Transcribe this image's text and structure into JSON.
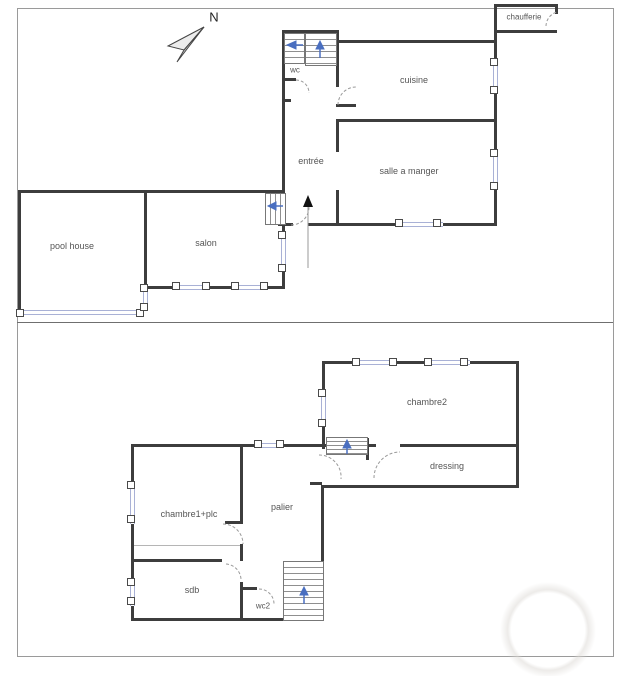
{
  "compass": {
    "label": "N"
  },
  "rooms": {
    "chaufferie": "chaufferie",
    "wc": "wc",
    "cuisine": "cuisine",
    "entree": "entrée",
    "salle_a_manger": "salle a manger",
    "pool_house": "pool house",
    "salon": "salon",
    "chambre2": "chambre2",
    "dressing": "dressing",
    "chambre1_plc": "chambre1+plc",
    "palier": "palier",
    "sdb": "sdb",
    "wc2": "wc2"
  },
  "colors": {
    "wall": "#3d3d3d",
    "window_frame": "#a9b1d6",
    "door_swing": "#999999",
    "stair_arrow": "#4a6fc0",
    "entrance_arrow": "#111111",
    "label_text": "#555555",
    "frame_border": "#9a9a9a"
  }
}
